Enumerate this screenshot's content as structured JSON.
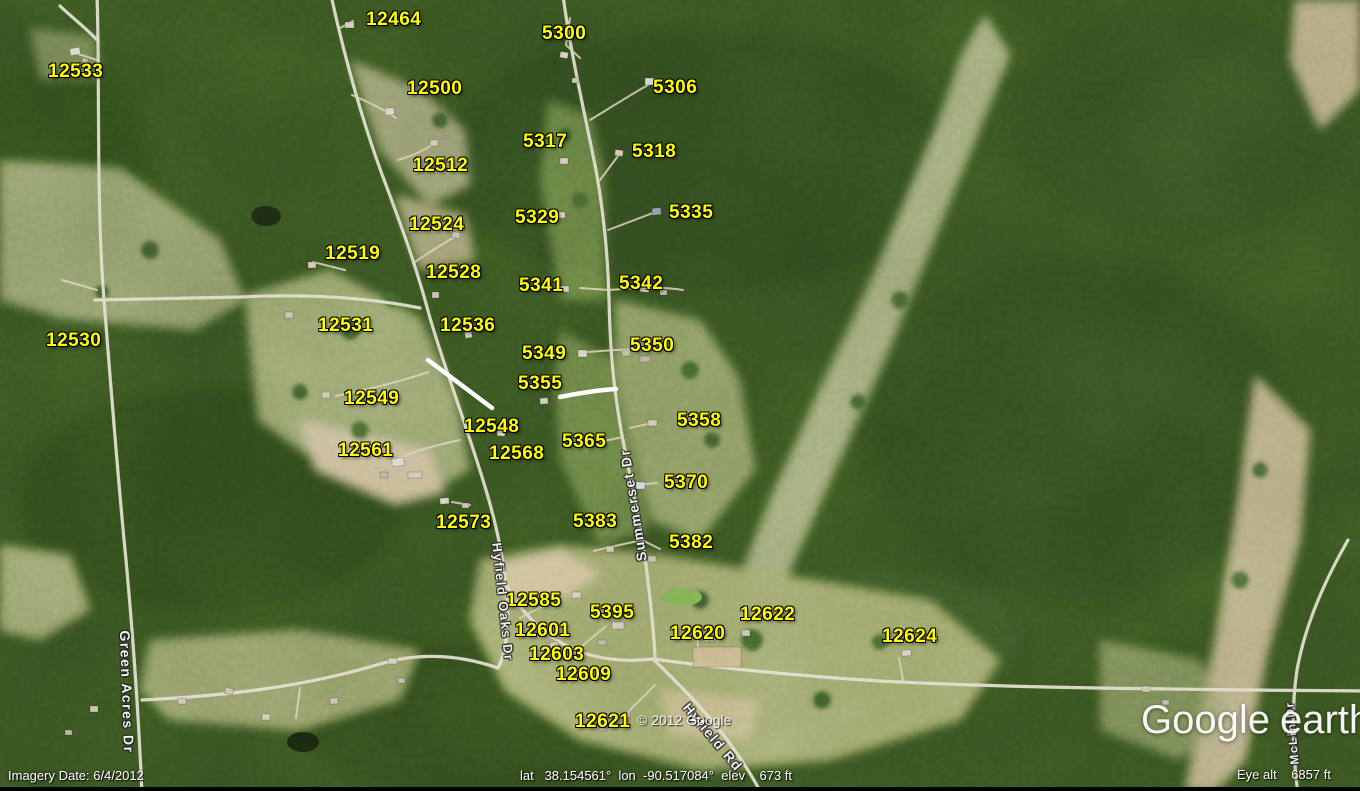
{
  "map": {
    "label_color": "#ffff00",
    "address_labels": [
      {
        "text": "12464",
        "x": 366,
        "y": 10
      },
      {
        "text": "5300",
        "x": 542,
        "y": 24
      },
      {
        "text": "12533",
        "x": 48,
        "y": 62
      },
      {
        "text": "12500",
        "x": 407,
        "y": 79
      },
      {
        "text": "5306",
        "x": 653,
        "y": 78
      },
      {
        "text": "5317",
        "x": 523,
        "y": 132
      },
      {
        "text": "5318",
        "x": 632,
        "y": 142
      },
      {
        "text": "12512",
        "x": 413,
        "y": 156
      },
      {
        "text": "5329",
        "x": 515,
        "y": 208
      },
      {
        "text": "5335",
        "x": 669,
        "y": 203
      },
      {
        "text": "12524",
        "x": 409,
        "y": 215
      },
      {
        "text": "12519",
        "x": 325,
        "y": 244
      },
      {
        "text": "12528",
        "x": 426,
        "y": 263
      },
      {
        "text": "5341",
        "x": 519,
        "y": 276
      },
      {
        "text": "5342",
        "x": 619,
        "y": 274
      },
      {
        "text": "12531",
        "x": 318,
        "y": 316
      },
      {
        "text": "12536",
        "x": 440,
        "y": 316
      },
      {
        "text": "12530",
        "x": 46,
        "y": 331
      },
      {
        "text": "5349",
        "x": 522,
        "y": 344
      },
      {
        "text": "5350",
        "x": 630,
        "y": 336
      },
      {
        "text": "5355",
        "x": 518,
        "y": 374
      },
      {
        "text": "12549",
        "x": 344,
        "y": 389
      },
      {
        "text": "5358",
        "x": 677,
        "y": 411
      },
      {
        "text": "12548",
        "x": 464,
        "y": 417
      },
      {
        "text": "5365",
        "x": 562,
        "y": 432
      },
      {
        "text": "12561",
        "x": 338,
        "y": 441
      },
      {
        "text": "12568",
        "x": 489,
        "y": 444
      },
      {
        "text": "5370",
        "x": 664,
        "y": 473
      },
      {
        "text": "12573",
        "x": 436,
        "y": 513
      },
      {
        "text": "5383",
        "x": 573,
        "y": 512
      },
      {
        "text": "5382",
        "x": 669,
        "y": 533
      },
      {
        "text": "12585",
        "x": 506,
        "y": 591
      },
      {
        "text": "5395",
        "x": 590,
        "y": 603
      },
      {
        "text": "12601",
        "x": 515,
        "y": 621
      },
      {
        "text": "12622",
        "x": 740,
        "y": 605
      },
      {
        "text": "12620",
        "x": 670,
        "y": 624
      },
      {
        "text": "12624",
        "x": 882,
        "y": 627
      },
      {
        "text": "12603",
        "x": 529,
        "y": 645
      },
      {
        "text": "12609",
        "x": 556,
        "y": 665
      },
      {
        "text": "12621",
        "x": 575,
        "y": 712
      }
    ],
    "road_labels": [
      {
        "text": "Green Acres Dr",
        "x": 127,
        "y": 692,
        "rotate": 88,
        "size": 14
      },
      {
        "text": "Hyfield Oaks Dr",
        "x": 503,
        "y": 602,
        "rotate": 84,
        "size": 13
      },
      {
        "text": "Summerset Dr",
        "x": 633,
        "y": 505,
        "rotate": -99,
        "size": 14
      },
      {
        "text": "Hyfield Rd",
        "x": 713,
        "y": 737,
        "rotate": 50,
        "size": 14
      },
      {
        "text": "McLin Dr",
        "x": 1292,
        "y": 733,
        "rotate": -95,
        "size": 12
      }
    ]
  },
  "overlay": {
    "copyright": "© 2012 Google",
    "logo_google": "Google",
    "logo_earth": "earth"
  },
  "status_bar": {
    "imagery_date": "Imagery Date: 6/4/2012",
    "coordinates": "lat   38.154561°  lon  -90.517084°  elev    673 ft",
    "eye_alt": "Eye alt    6857 ft"
  }
}
